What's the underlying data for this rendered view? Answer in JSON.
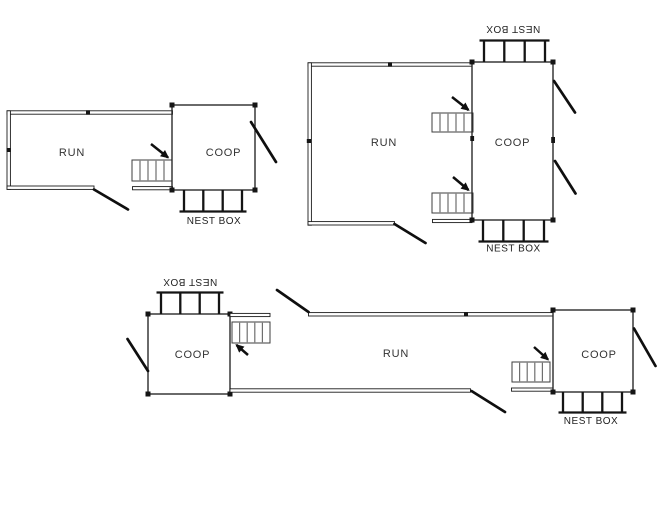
{
  "colors": {
    "background": "#ffffff",
    "line": "#1b1b1b"
  },
  "plans": [
    {
      "id": "plan-1",
      "run_label": "RUN",
      "coop_label": "COOP",
      "nest_box_label": "NEST BOX"
    },
    {
      "id": "plan-2",
      "run_label": "RUN",
      "coop_label": "COOP",
      "nest_box_top_label": "NEST BOX",
      "nest_box_bottom_label": "NEST BOX"
    },
    {
      "id": "plan-3",
      "coop_left_label": "COOP",
      "run_label": "RUN",
      "coop_right_label": "COOP",
      "nest_box_left_label": "NEST BOX",
      "nest_box_right_label": "NEST BOX"
    }
  ]
}
